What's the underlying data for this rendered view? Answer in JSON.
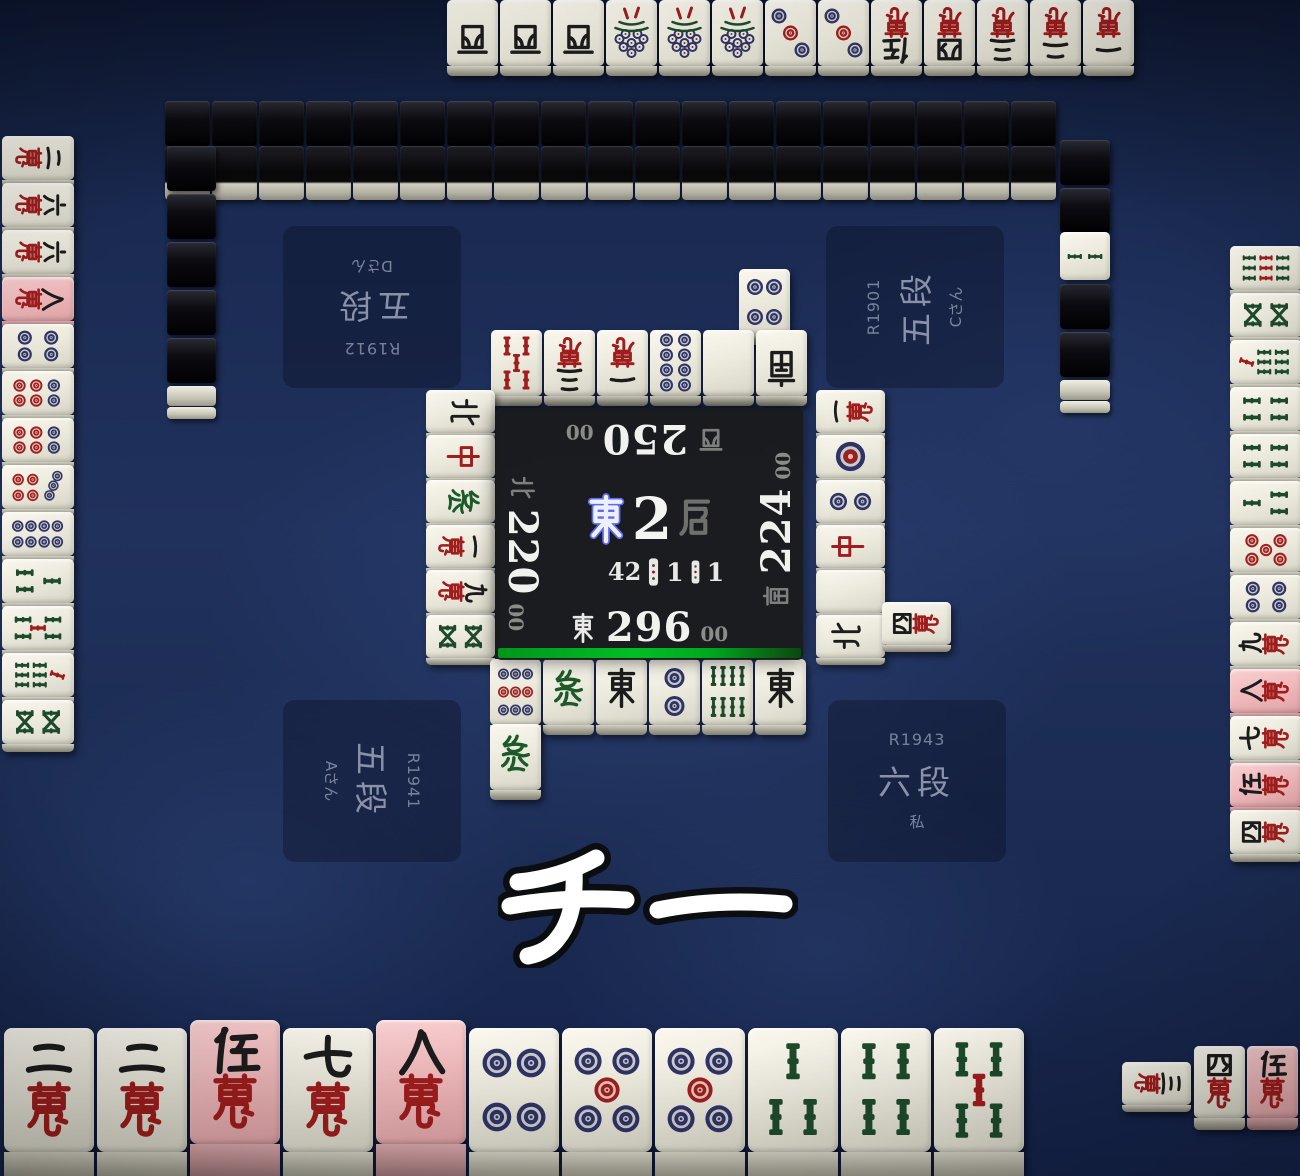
{
  "title": "Tenhou mahjong table",
  "call_banner": "チー",
  "colors": {
    "felt": "#1b2b52",
    "panel": "#1a1a1a",
    "turn_bar": "#00b31e",
    "tile_face": "#edebde",
    "tile_back": "#0b0b0f",
    "highlight_pink": "#f0b9bb",
    "man_red": "#a01d1d",
    "sou_green": "#1d4a2b",
    "pin_navy": "#2f3365",
    "round_wind_blue": "#9aa6ff",
    "score_white": "#f1f1ee",
    "dim_gray": "#8b8b88"
  },
  "center": {
    "round": {
      "wind": "東",
      "number": "2",
      "suffix": "局"
    },
    "tiles_remaining": "42",
    "riichi_sticks": "1",
    "honba": "1",
    "seats": {
      "bottom": {
        "wind": "東",
        "score": "296",
        "suffix": "00"
      },
      "right": {
        "wind": "南",
        "score": "224",
        "suffix": "00"
      },
      "top": {
        "wind": "西",
        "score": "250",
        "suffix": "00"
      },
      "left": {
        "wind": "北",
        "score": "220",
        "suffix": "00"
      }
    }
  },
  "plates": {
    "top_left": [
      "R1912",
      "五段",
      "Dさん"
    ],
    "top_right": [
      "R1901",
      "五段",
      "Cさん"
    ],
    "bottom_left": [
      "R1941",
      "五段",
      "Aさん"
    ],
    "bottom_right": [
      "R1943",
      "六段",
      "私"
    ]
  },
  "hands": {
    "bottom": [
      "m2",
      "m2",
      "m5*",
      "m7",
      "m8*",
      "p4",
      "p5",
      "p5",
      "s3",
      "s4",
      "s5"
    ],
    "top": [
      "W",
      "W",
      "W",
      "s1",
      "s1",
      "s1",
      "p3",
      "p3",
      "m5",
      "m4",
      "m3",
      "m2",
      "m1"
    ],
    "left": [
      "m2",
      "m6",
      "m6",
      "m8*",
      "p4",
      "p6",
      "p6",
      "p7",
      "p8",
      "s3",
      "s5",
      "s7",
      "s6"
    ],
    "right": [
      "s9",
      "s6",
      "s7",
      "s4",
      "s4",
      "s3",
      "p0",
      "p4",
      "m9",
      "m8*",
      "m7",
      "m5*",
      "m4"
    ]
  },
  "melds": {
    "bottom_right_chii": {
      "called_rotated": "m3",
      "upright": [
        "m4",
        "m5*"
      ]
    }
  },
  "rivers": {
    "top_row1": [
      "s5r",
      "m3",
      "m1",
      "p8",
      "B",
      "S"
    ],
    "top_row2": [
      "p4"
    ],
    "left": [
      "N",
      "C",
      "H",
      "m1",
      "m9",
      "s6"
    ],
    "right_col1": [
      "m1",
      "p1",
      "p2",
      "C",
      "B",
      "N"
    ],
    "right_col2": [
      "m4"
    ],
    "bottom_row1": [
      "p9",
      "H",
      "E",
      "p2",
      "s8",
      "E"
    ],
    "bottom_row2": [
      "H"
    ]
  },
  "walls": {
    "top_back_count": 19,
    "top_front_count": 19,
    "left_back_count": 5,
    "right_back_above": 2,
    "right_back_below": 2,
    "dora_indicator": "s2"
  },
  "tile_labels": {
    "m1": "一萬",
    "m2": "二萬",
    "m3": "三萬",
    "m4": "四萬",
    "m5": "伍萬",
    "m6": "六萬",
    "m7": "七萬",
    "m8": "八萬",
    "m9": "九萬",
    "p1": "一筒",
    "p2": "二筒",
    "p3": "三筒",
    "p4": "四筒",
    "p5": "五筒",
    "p0": "赤五筒",
    "p6": "六筒",
    "p7": "七筒",
    "p8": "八筒",
    "p9": "九筒",
    "s1": "一索",
    "s2": "二索",
    "s3": "三索",
    "s4": "四索",
    "s5": "五索",
    "s5r": "赤五索",
    "s6": "六索",
    "s7": "七索",
    "s8": "八索",
    "s9": "九索",
    "E": "東",
    "S": "南",
    "W": "西",
    "N": "北",
    "C": "中",
    "H": "發",
    "B": "白"
  }
}
